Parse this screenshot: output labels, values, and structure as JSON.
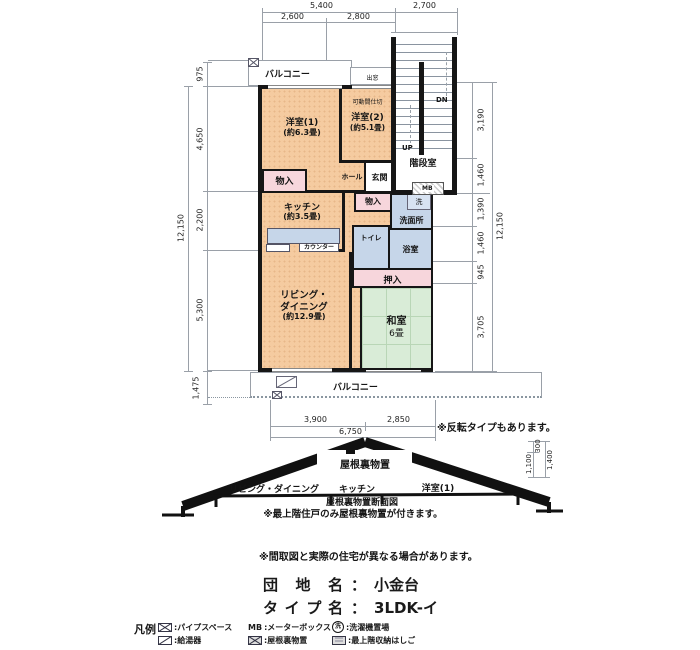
{
  "colors": {
    "room_peach": "#f5cba0",
    "closet_pink": "#f7d6dc",
    "wet_blue": "#c6d6e9",
    "tatami_green": "#d9ecd7",
    "wall_black": "#161616"
  },
  "dims": {
    "top": {
      "t5400": "5,400",
      "t2700": "2,700",
      "t2600": "2,600",
      "t2800": "2,800"
    },
    "left": {
      "d975": "975",
      "d4650": "4,650",
      "d2200": "2,200",
      "d5300": "5,300",
      "d1475": "1,475",
      "total": "12,150"
    },
    "right": {
      "d3190": "3,190",
      "d1460a": "1,460",
      "d1390": "1,390",
      "d1460b": "1,460",
      "d945": "945",
      "d3705": "3,705",
      "total": "12,150"
    },
    "bottom": {
      "d3900": "3,900",
      "d2850": "2,850",
      "total": "6,750"
    },
    "roof": {
      "d300": "300",
      "d1100": "1,100",
      "d1400": "1,400"
    }
  },
  "plan": {
    "balcony_top": "バルコニー",
    "balcony_bottom": "バルコニー",
    "bay_window": "出窓",
    "note_reverse": "※反転タイプもあります。",
    "stair_room": "階段室",
    "up": "UP",
    "dn": "DN",
    "mb": "MB",
    "yoshitsu1_name": "洋室(1)",
    "yoshitsu1_size": "(約6.3畳)",
    "yoshitsu2_name": "洋室(2)",
    "yoshitsu2_size": "(約5.1畳)",
    "partition": "可動間仕切",
    "hall": "ホール",
    "genkan": "玄関",
    "monoire_a": "物入",
    "monoire_b": "物入",
    "kitchen_name": "キッチン",
    "kitchen_size": "(約3.5畳)",
    "counter": "カウンター",
    "laundry": "洗",
    "senmenjo": "洗面所",
    "toilet": "トイレ",
    "bath": "浴室",
    "oshiire": "押入",
    "living_name1": "リビング・",
    "living_name2": "ダイニング",
    "living_size": "(約12.9畳)",
    "washitsu_name": "和室",
    "washitsu_size": "6畳"
  },
  "section": {
    "attic": "屋根裏物置",
    "room_living": "リビング・ダイニング",
    "room_kitchen": "キッチン",
    "room_yoshitsu1": "洋室(1)",
    "caption": "屋根裏物置断面図",
    "note": "※最上階住戸のみ屋根裏物置が付きます。"
  },
  "footer": {
    "disclaimer": "※間取図と実際の住宅が異なる場合があります。",
    "danchi_label": "団 地 名",
    "danchi_sep": "：",
    "danchi_value": "小金台",
    "type_label": "タイプ名",
    "type_sep": "：",
    "type_value": "3LDK-イ"
  },
  "legend": {
    "title": "凡例",
    "pipe_space": ":パイプスペース",
    "mb_prefix": "MB",
    "mb": ":メーターボックス",
    "laundry_prefix": "洗",
    "laundry": ":洗濯機置場",
    "water_heater": ":給湯器",
    "attic": ":屋根裏物置",
    "ladder": ":最上階収納はしご"
  }
}
